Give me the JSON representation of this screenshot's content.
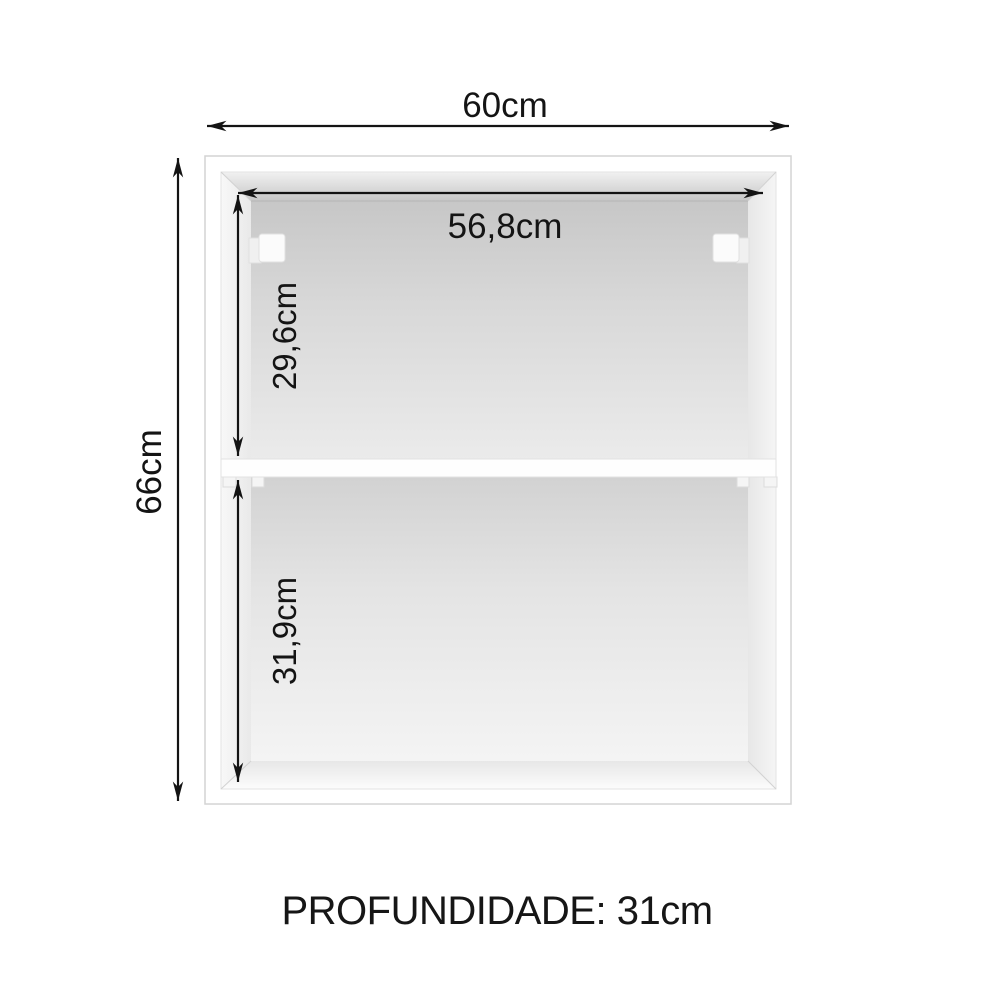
{
  "dimensions": {
    "outer_width": "60cm",
    "outer_height": "66cm",
    "inner_width": "56,8cm",
    "upper_compartment_height": "29,6cm",
    "lower_compartment_height": "31,9cm",
    "depth_note": "PROFUNDIDADE: 31cm"
  },
  "colors": {
    "background": "#ffffff",
    "dimension_ink": "#141414",
    "cabinet_edge": "#d4d4d4",
    "interior_shade_dark": "#c7c7c7",
    "interior_shade_light": "#f3f3f3"
  },
  "icons": {
    "arrowheads": "double-headed-dimension-arrows"
  }
}
